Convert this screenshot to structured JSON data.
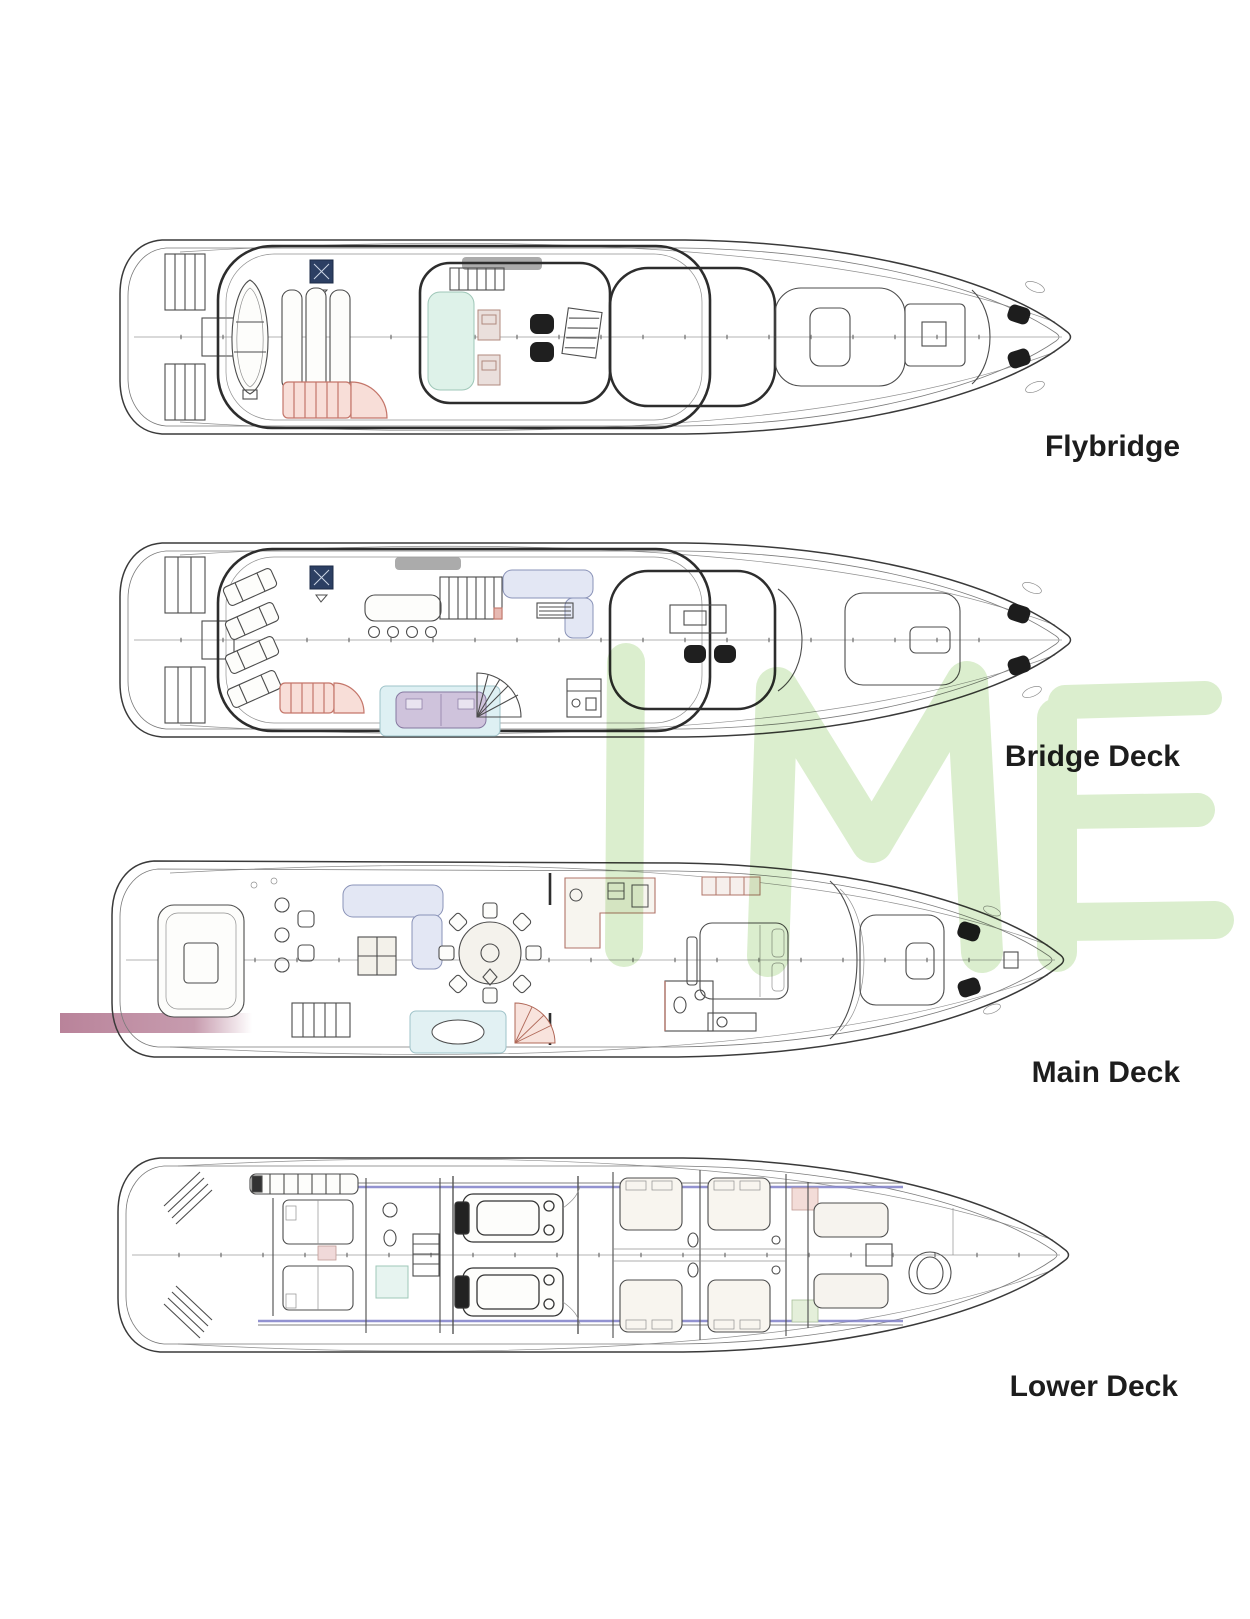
{
  "page": {
    "background": "#ffffff"
  },
  "watermark": {
    "text": "IME",
    "color": "#d8edca"
  },
  "decks": [
    {
      "id": "flybridge",
      "label": "Flybridge"
    },
    {
      "id": "bridge-deck",
      "label": "Bridge Deck"
    },
    {
      "id": "main-deck",
      "label": "Main Deck"
    },
    {
      "id": "lower-deck",
      "label": "Lower Deck"
    }
  ],
  "colors": {
    "line": "#3a3a3a",
    "line_light": "#909090",
    "label_text": "#1d1d1d",
    "accent_navy": "#2c3f63",
    "accent_red_stroke": "#c4766a",
    "accent_red_fill": "#f8ded8",
    "accent_mint": "#def2e9",
    "accent_rug_blue": "#e2f1f3",
    "accent_table_purple": "#cfc3dc",
    "accent_sofa_blue": "#e3e7f4",
    "accent_gangway_rose": "#bd8aa0",
    "accent_shaft_purple": "#8080c8",
    "roof_grey": "#9c9c9c"
  }
}
